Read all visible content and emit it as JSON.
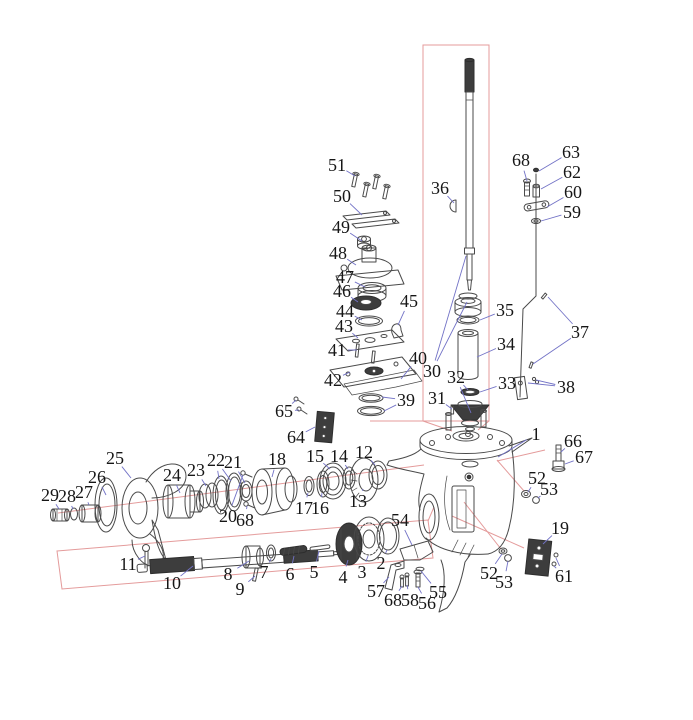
{
  "diagram": {
    "description": "Exploded parts diagram of an outboard motor lower unit gearcase",
    "colors": {
      "background": "#ffffff",
      "line_art": "#4a4a4a",
      "dark_part": "#3d3d3d",
      "leader": "#7272c6",
      "highlight_box": "#e49b9b",
      "shift_rod": "#b06a5a",
      "label_text": "#161616"
    },
    "labels": [
      {
        "n": "36",
        "x": 440,
        "y": 188,
        "to": [
          [
            454,
            203
          ]
        ]
      },
      {
        "n": "51",
        "x": 337,
        "y": 165,
        "to": [
          [
            355,
            176
          ]
        ]
      },
      {
        "n": "50",
        "x": 342,
        "y": 196,
        "to": [
          [
            362,
            215
          ]
        ]
      },
      {
        "n": "49",
        "x": 341,
        "y": 227,
        "to": [
          [
            362,
            241
          ]
        ]
      },
      {
        "n": "48",
        "x": 338,
        "y": 253,
        "to": [
          [
            356,
            265
          ]
        ]
      },
      {
        "n": "47",
        "x": 345,
        "y": 277,
        "to": [
          [
            365,
            287
          ]
        ]
      },
      {
        "n": "46",
        "x": 342,
        "y": 291,
        "to": [
          [
            358,
            302
          ]
        ]
      },
      {
        "n": "44",
        "x": 345,
        "y": 311,
        "to": [
          [
            362,
            320
          ]
        ]
      },
      {
        "n": "43",
        "x": 344,
        "y": 326,
        "to": [
          [
            358,
            338
          ]
        ]
      },
      {
        "n": "41",
        "x": 337,
        "y": 350,
        "to": [
          [
            357,
            350
          ]
        ]
      },
      {
        "n": "42",
        "x": 333,
        "y": 380,
        "to": [
          [
            350,
            372
          ]
        ]
      },
      {
        "n": "45",
        "x": 409,
        "y": 301,
        "to": [
          [
            398,
            325
          ]
        ]
      },
      {
        "n": "40",
        "x": 418,
        "y": 358,
        "to": [
          [
            401,
            379
          ]
        ]
      },
      {
        "n": "39",
        "x": 406,
        "y": 400,
        "to": [
          [
            382,
            397
          ],
          [
            384,
            411
          ]
        ]
      },
      {
        "n": "30",
        "x": 432,
        "y": 371,
        "to": [
          [
            466,
            256
          ],
          [
            467,
            302
          ]
        ]
      },
      {
        "n": "31",
        "x": 437,
        "y": 398,
        "to": [
          [
            452,
            409
          ]
        ]
      },
      {
        "n": "32",
        "x": 456,
        "y": 377,
        "to": [
          [
            468,
            390
          ],
          [
            471,
            413
          ]
        ]
      },
      {
        "n": "35",
        "x": 505,
        "y": 310,
        "to": [
          [
            480,
            320
          ]
        ]
      },
      {
        "n": "34",
        "x": 506,
        "y": 344,
        "to": [
          [
            477,
            357
          ]
        ]
      },
      {
        "n": "33",
        "x": 507,
        "y": 383,
        "to": [
          [
            480,
            392
          ]
        ]
      },
      {
        "n": "68",
        "x": 521,
        "y": 160,
        "to": [
          [
            527,
            181
          ]
        ]
      },
      {
        "n": "63",
        "x": 571,
        "y": 152,
        "to": [
          [
            539,
            171
          ]
        ]
      },
      {
        "n": "62",
        "x": 572,
        "y": 172,
        "to": [
          [
            541,
            189
          ]
        ]
      },
      {
        "n": "60",
        "x": 573,
        "y": 192,
        "to": [
          [
            547,
            207
          ]
        ]
      },
      {
        "n": "59",
        "x": 572,
        "y": 212,
        "to": [
          [
            541,
            221
          ]
        ]
      },
      {
        "n": "37",
        "x": 580,
        "y": 332,
        "to": [
          [
            548,
            297
          ],
          [
            533,
            364
          ]
        ]
      },
      {
        "n": "38",
        "x": 566,
        "y": 387,
        "to": [
          [
            528,
            383
          ],
          [
            536,
            380
          ]
        ]
      },
      {
        "n": "65",
        "x": 284,
        "y": 411,
        "to": [
          [
            296,
            400
          ],
          [
            299,
            410
          ]
        ]
      },
      {
        "n": "64",
        "x": 296,
        "y": 437,
        "to": [
          [
            315,
            427
          ]
        ]
      },
      {
        "n": "25",
        "x": 115,
        "y": 458,
        "to": [
          [
            131,
            478
          ]
        ]
      },
      {
        "n": "26",
        "x": 97,
        "y": 477,
        "to": [
          [
            106,
            495
          ]
        ]
      },
      {
        "n": "24",
        "x": 172,
        "y": 475,
        "to": [
          [
            180,
            493
          ]
        ]
      },
      {
        "n": "29",
        "x": 50,
        "y": 495,
        "to": [
          [
            59,
            509
          ]
        ]
      },
      {
        "n": "28",
        "x": 67,
        "y": 496,
        "to": [
          [
            73,
            509
          ]
        ]
      },
      {
        "n": "27",
        "x": 84,
        "y": 492,
        "to": [
          [
            89,
            505
          ]
        ]
      },
      {
        "n": "23",
        "x": 196,
        "y": 470,
        "to": [
          [
            206,
            486
          ]
        ]
      },
      {
        "n": "22",
        "x": 216,
        "y": 460,
        "to": [
          [
            219,
            479
          ],
          [
            231,
            481
          ]
        ]
      },
      {
        "n": "21",
        "x": 233,
        "y": 462,
        "to": [
          [
            245,
            483
          ]
        ]
      },
      {
        "n": "18",
        "x": 277,
        "y": 459,
        "to": [
          [
            272,
            477
          ]
        ]
      },
      {
        "n": "20",
        "x": 228,
        "y": 516,
        "to": [
          [
            243,
            475
          ]
        ]
      },
      {
        "n": "68",
        "x": 245,
        "y": 520,
        "to": [
          [
            247,
            506
          ]
        ]
      },
      {
        "n": "15",
        "x": 315,
        "y": 456,
        "to": [
          [
            330,
            469
          ]
        ]
      },
      {
        "n": "14",
        "x": 339,
        "y": 456,
        "to": [
          [
            348,
            469
          ]
        ]
      },
      {
        "n": "12",
        "x": 364,
        "y": 452,
        "to": [
          [
            375,
            465
          ]
        ]
      },
      {
        "n": "13",
        "x": 358,
        "y": 501,
        "to": [
          [
            363,
            489
          ]
        ]
      },
      {
        "n": "17",
        "x": 304,
        "y": 508,
        "to": [
          [
            308,
            493
          ]
        ]
      },
      {
        "n": "16",
        "x": 320,
        "y": 508,
        "to": [
          [
            322,
            493
          ]
        ]
      },
      {
        "n": "11",
        "x": 128,
        "y": 564,
        "to": [
          [
            145,
            556
          ]
        ]
      },
      {
        "n": "10",
        "x": 172,
        "y": 583,
        "to": [
          [
            193,
            566
          ]
        ]
      },
      {
        "n": "8",
        "x": 228,
        "y": 574,
        "to": [
          [
            249,
            561
          ]
        ]
      },
      {
        "n": "9",
        "x": 240,
        "y": 589,
        "to": [
          [
            255,
            576
          ]
        ]
      },
      {
        "n": "7",
        "x": 264,
        "y": 572,
        "to": [
          [
            271,
            559
          ]
        ]
      },
      {
        "n": "6",
        "x": 290,
        "y": 574,
        "to": [
          [
            294,
            556
          ]
        ]
      },
      {
        "n": "5",
        "x": 314,
        "y": 572,
        "to": [
          [
            319,
            551
          ]
        ]
      },
      {
        "n": "4",
        "x": 343,
        "y": 577,
        "to": [
          [
            348,
            560
          ]
        ]
      },
      {
        "n": "3",
        "x": 362,
        "y": 572,
        "to": [
          [
            368,
            556
          ]
        ]
      },
      {
        "n": "2",
        "x": 381,
        "y": 563,
        "to": [
          [
            387,
            550
          ]
        ]
      },
      {
        "n": "54",
        "x": 400,
        "y": 520,
        "to": [
          [
            412,
            545
          ]
        ]
      },
      {
        "n": "57",
        "x": 376,
        "y": 591,
        "to": [
          [
            389,
            577
          ]
        ]
      },
      {
        "n": "68",
        "x": 393,
        "y": 600,
        "to": [
          [
            402,
            586
          ]
        ]
      },
      {
        "n": "58",
        "x": 410,
        "y": 600,
        "to": [
          [
            407,
            585
          ]
        ]
      },
      {
        "n": "56",
        "x": 427,
        "y": 603,
        "to": [
          [
            418,
            587
          ]
        ]
      },
      {
        "n": "55",
        "x": 438,
        "y": 592,
        "to": [
          [
            421,
            571
          ]
        ]
      },
      {
        "n": "52",
        "x": 489,
        "y": 573,
        "to": [
          [
            502,
            554
          ]
        ]
      },
      {
        "n": "53",
        "x": 504,
        "y": 582,
        "to": [
          [
            508,
            561
          ]
        ]
      },
      {
        "n": "19",
        "x": 560,
        "y": 528,
        "to": [
          [
            543,
            544
          ]
        ]
      },
      {
        "n": "61",
        "x": 564,
        "y": 576,
        "to": [
          [
            556,
            558
          ],
          [
            554,
            566
          ]
        ]
      },
      {
        "n": "1",
        "x": 536,
        "y": 434,
        "to": [
          [
            498,
            457
          ]
        ]
      },
      {
        "n": "66",
        "x": 573,
        "y": 441,
        "to": [
          [
            561,
            452
          ]
        ]
      },
      {
        "n": "67",
        "x": 584,
        "y": 457,
        "to": [
          [
            565,
            464
          ]
        ]
      },
      {
        "n": "52",
        "x": 537,
        "y": 478,
        "to": [
          [
            528,
            492
          ]
        ]
      },
      {
        "n": "53",
        "x": 549,
        "y": 489,
        "to": [
          [
            538,
            498
          ]
        ]
      }
    ]
  }
}
